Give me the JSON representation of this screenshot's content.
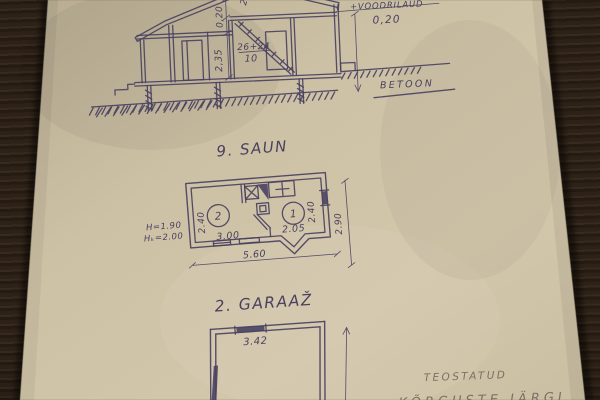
{
  "scene": {
    "description": "Hand-drawn architectural sheet on aged paper photographed on a dark wood table",
    "colors": {
      "ink": "#4a4161",
      "pencil": "#7b7063",
      "paper": "#cec2a6",
      "paper_shade": "#b4a98e",
      "wood_dark": "#241b13",
      "wood_mid": "#372a1e"
    }
  },
  "section_drawing": {
    "dim_roof_vertical": "0,20",
    "dim_wall_height": "2,35",
    "fraction_numerator": "26+24",
    "fraction_denominator": "10",
    "dim_partial_top": "2,4",
    "note_top_partial": "ROOVITIS",
    "note_cladding": "+VOODRILAUD",
    "dim_cladding": "0,20",
    "label_foundation": "BETOON"
  },
  "saun_plan": {
    "title": "9. SAUN",
    "room_1_number": "1",
    "room_2_number": "2",
    "dim_room2_height": "2.40",
    "dim_room2_width": "3.00",
    "dim_room1_width": "2.05",
    "dim_room1_height": "2.40",
    "dim_overall_width": "5.60",
    "dim_overall_depth": "2.90",
    "note_height_1": "H=1.90",
    "note_height_2": "Hₖ=2.00"
  },
  "garage_plan": {
    "title": "2. GARAAŽ",
    "dim_opening": "3.42"
  },
  "site_notes": {
    "stamp": "TEOSTATUD",
    "stamp_line2_partial": "KÕRGUSTE JÄRGI"
  }
}
